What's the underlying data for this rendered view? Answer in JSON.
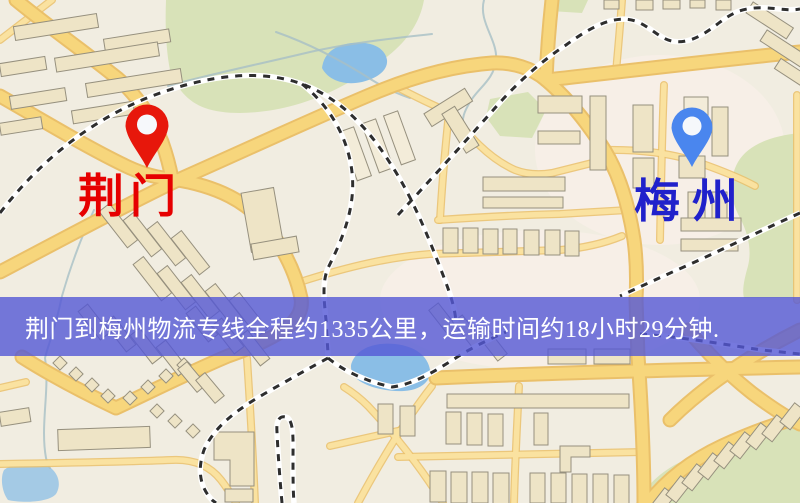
{
  "map": {
    "origin": {
      "label": "荆门"
    },
    "destination": {
      "label": "梅州"
    }
  },
  "banner": {
    "text": "荆门到梅州物流专线全程约1335公里，运输时间约18小时29分钟."
  },
  "icons": {
    "origin_pin": "map-pin",
    "destination_pin": "map-pin"
  },
  "palette": {
    "background": "#f1ede1",
    "park": "#d8e2b8",
    "water": "#8abee6",
    "stream": "#a8bfc6",
    "road_major": "#f7d67c",
    "road_minor": "#fae2a0",
    "road_casing": "#eac06a",
    "building": "#eee4c6",
    "building_pale": "#f3ecd9",
    "building_stroke": "#96907e",
    "rail": "#2e2e2e",
    "banner_bg": "rgba(84,88,214,0.8)",
    "banner_text": "#ffffff",
    "origin_label": "#e60000",
    "destination_label": "#2021cb",
    "origin_pin": "#e7170b",
    "destination_pin": "#4a86ee",
    "pin_inner": "#f6f8fb"
  }
}
